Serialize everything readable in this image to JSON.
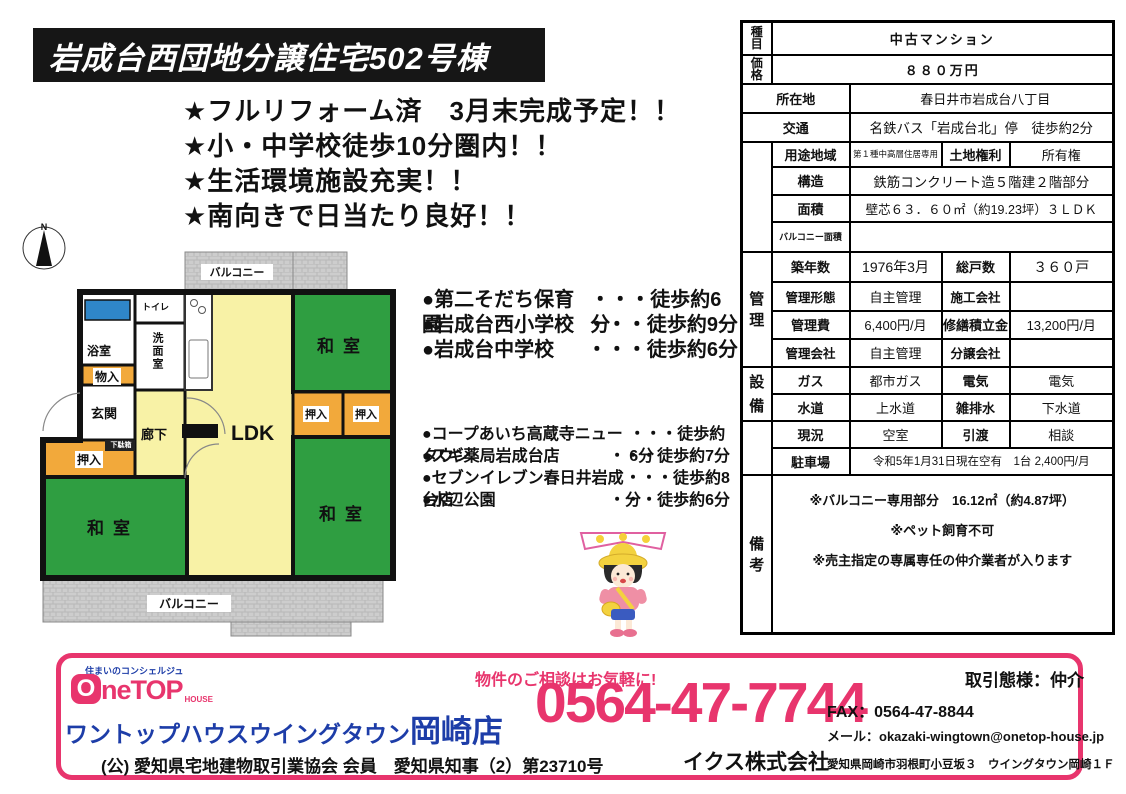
{
  "banner": {
    "title": "岩成台西団地分譲住宅502号棟"
  },
  "catch": {
    "lines": [
      "★フルリフォーム済　3月末完成予定！！",
      "★小・中学校徒歩10分圏内！！",
      "★生活環境施設充実！！",
      "★南向きで日当たり良好！！"
    ]
  },
  "compass": {
    "n": "N"
  },
  "floorplan": {
    "balcony": "バルコニー",
    "bath": "浴室",
    "toilet": "トイレ",
    "washroom": "洗面室",
    "storage": "物入",
    "entrance": "玄関",
    "corridor": "廊下",
    "shoebox": "下駄箱",
    "closet": "押入",
    "ldk": "LDK",
    "tatami": "和室"
  },
  "schools": [
    {
      "name": "●第二そだち保育園",
      "walk": "・・・徒歩約6分"
    },
    {
      "name": "●岩成台西小学校",
      "walk": "・・・徒歩約9分"
    },
    {
      "name": "●岩成台中学校",
      "walk": "・・・徒歩約6分"
    }
  ],
  "facilities": [
    {
      "name": "●コープあいち高蔵寺ニュータウン",
      "walk": "・・・徒歩約6分"
    },
    {
      "name": "●スギ薬局岩成台店",
      "walk": "・・・徒歩約7分"
    },
    {
      "name": "●セブンイレブン春日井岩成台店",
      "walk": "・・・徒歩約8分"
    },
    {
      "name": "●水辺公園",
      "walk": "・・・徒歩約6分"
    }
  ],
  "table": {
    "shumoku": {
      "label": [
        "種",
        "目"
      ],
      "value": "中古マンション"
    },
    "kakaku": {
      "label": [
        "価",
        "格"
      ],
      "value": "８８０万円"
    },
    "shozaichi": {
      "label": "所在地",
      "value": "春日井市岩成台八丁目"
    },
    "kotsu": {
      "label": "交通",
      "value": "名鉄バス「岩成台北」停　徒歩約2分"
    },
    "youto": {
      "label": "用途地域",
      "value": "第１種中高層住居専用"
    },
    "tochi": {
      "label": "土地権利",
      "value": "所有権"
    },
    "kouzou": {
      "label": "構造",
      "value": "鉄筋コンクリート造５階建２階部分"
    },
    "menseki": {
      "label": "面積",
      "value": "壁芯６３．６０㎡（約19.23坪）３ＬＤＫ"
    },
    "balcony": {
      "label": "バルコニー面積",
      "value": ""
    },
    "strip_kanri": [
      "管",
      "理"
    ],
    "chikunen": {
      "label": "築年数",
      "value": "1976年3月"
    },
    "soukosu": {
      "label": "総戸数",
      "value": "３６０戸"
    },
    "kanri_keitai": {
      "label": "管理形態",
      "value": "自主管理"
    },
    "sekou": {
      "label": "施工会社",
      "value": ""
    },
    "kanrihi": {
      "label": "管理費",
      "value": "6,400円/月"
    },
    "shuzen": {
      "label": "修繕積立金",
      "value": "13,200円/月"
    },
    "kanri_gaisha": {
      "label": "管理会社",
      "value": "自主管理"
    },
    "bunjou": {
      "label": "分譲会社",
      "value": ""
    },
    "strip_setsubi": [
      "設",
      "備"
    ],
    "gas": {
      "label": "ガス",
      "value": "都市ガス"
    },
    "denki": {
      "label": "電気",
      "value": "電気"
    },
    "suido": {
      "label": "水道",
      "value": "上水道"
    },
    "zappai": {
      "label": "雑排水",
      "value": "下水道"
    },
    "genkyo": {
      "label": "現況",
      "value": "空室"
    },
    "hikiwatashi": {
      "label": "引渡",
      "value": "相談"
    },
    "parking": {
      "label": "駐車場",
      "value": "令和5年1月31日現在空有　1台 2,400円/月"
    },
    "strip_bikou": [
      "備",
      "考"
    ],
    "bikou_lines": [
      "※バルコニー専用部分　16.12㎡（約4.87坪）",
      "※ペット飼育不可",
      "※売主指定の専属専任の仲介業者が入ります"
    ]
  },
  "footer": {
    "logo_tagline": "住まいのコンシェルジュ",
    "logo_o": "O",
    "logo_ne": "ne",
    "logo_top": "TOP",
    "logo_house": "HOUSE",
    "shop_name_main": "ワントップハウスウイングタウン",
    "shop_name_branch": "岡崎店",
    "license": "(公) 愛知県宅地建物取引業協会 会員　愛知県知事（2）第23710号",
    "contact_catch": "物件のご相談はお気軽に!",
    "phone": "0564-47-7744",
    "fax": "FAX：0564-47-8844",
    "mail": "メール：okazaki-wingtown@onetop-house.jp",
    "deal_type": "取引態様：仲介",
    "company": "イクス株式会社",
    "address": "愛知県岡崎市羽根町小豆坂３　ウイングタウン岡崎１Ｆ"
  },
  "colors": {
    "accent_pink": "#e8356d",
    "brand_blue": "#1d3da8",
    "tatami_green": "#2f9e41",
    "ldk_yellow": "#f8f2a6",
    "closet_orange": "#f2a93b",
    "bathtub_blue": "#2f86c8"
  }
}
